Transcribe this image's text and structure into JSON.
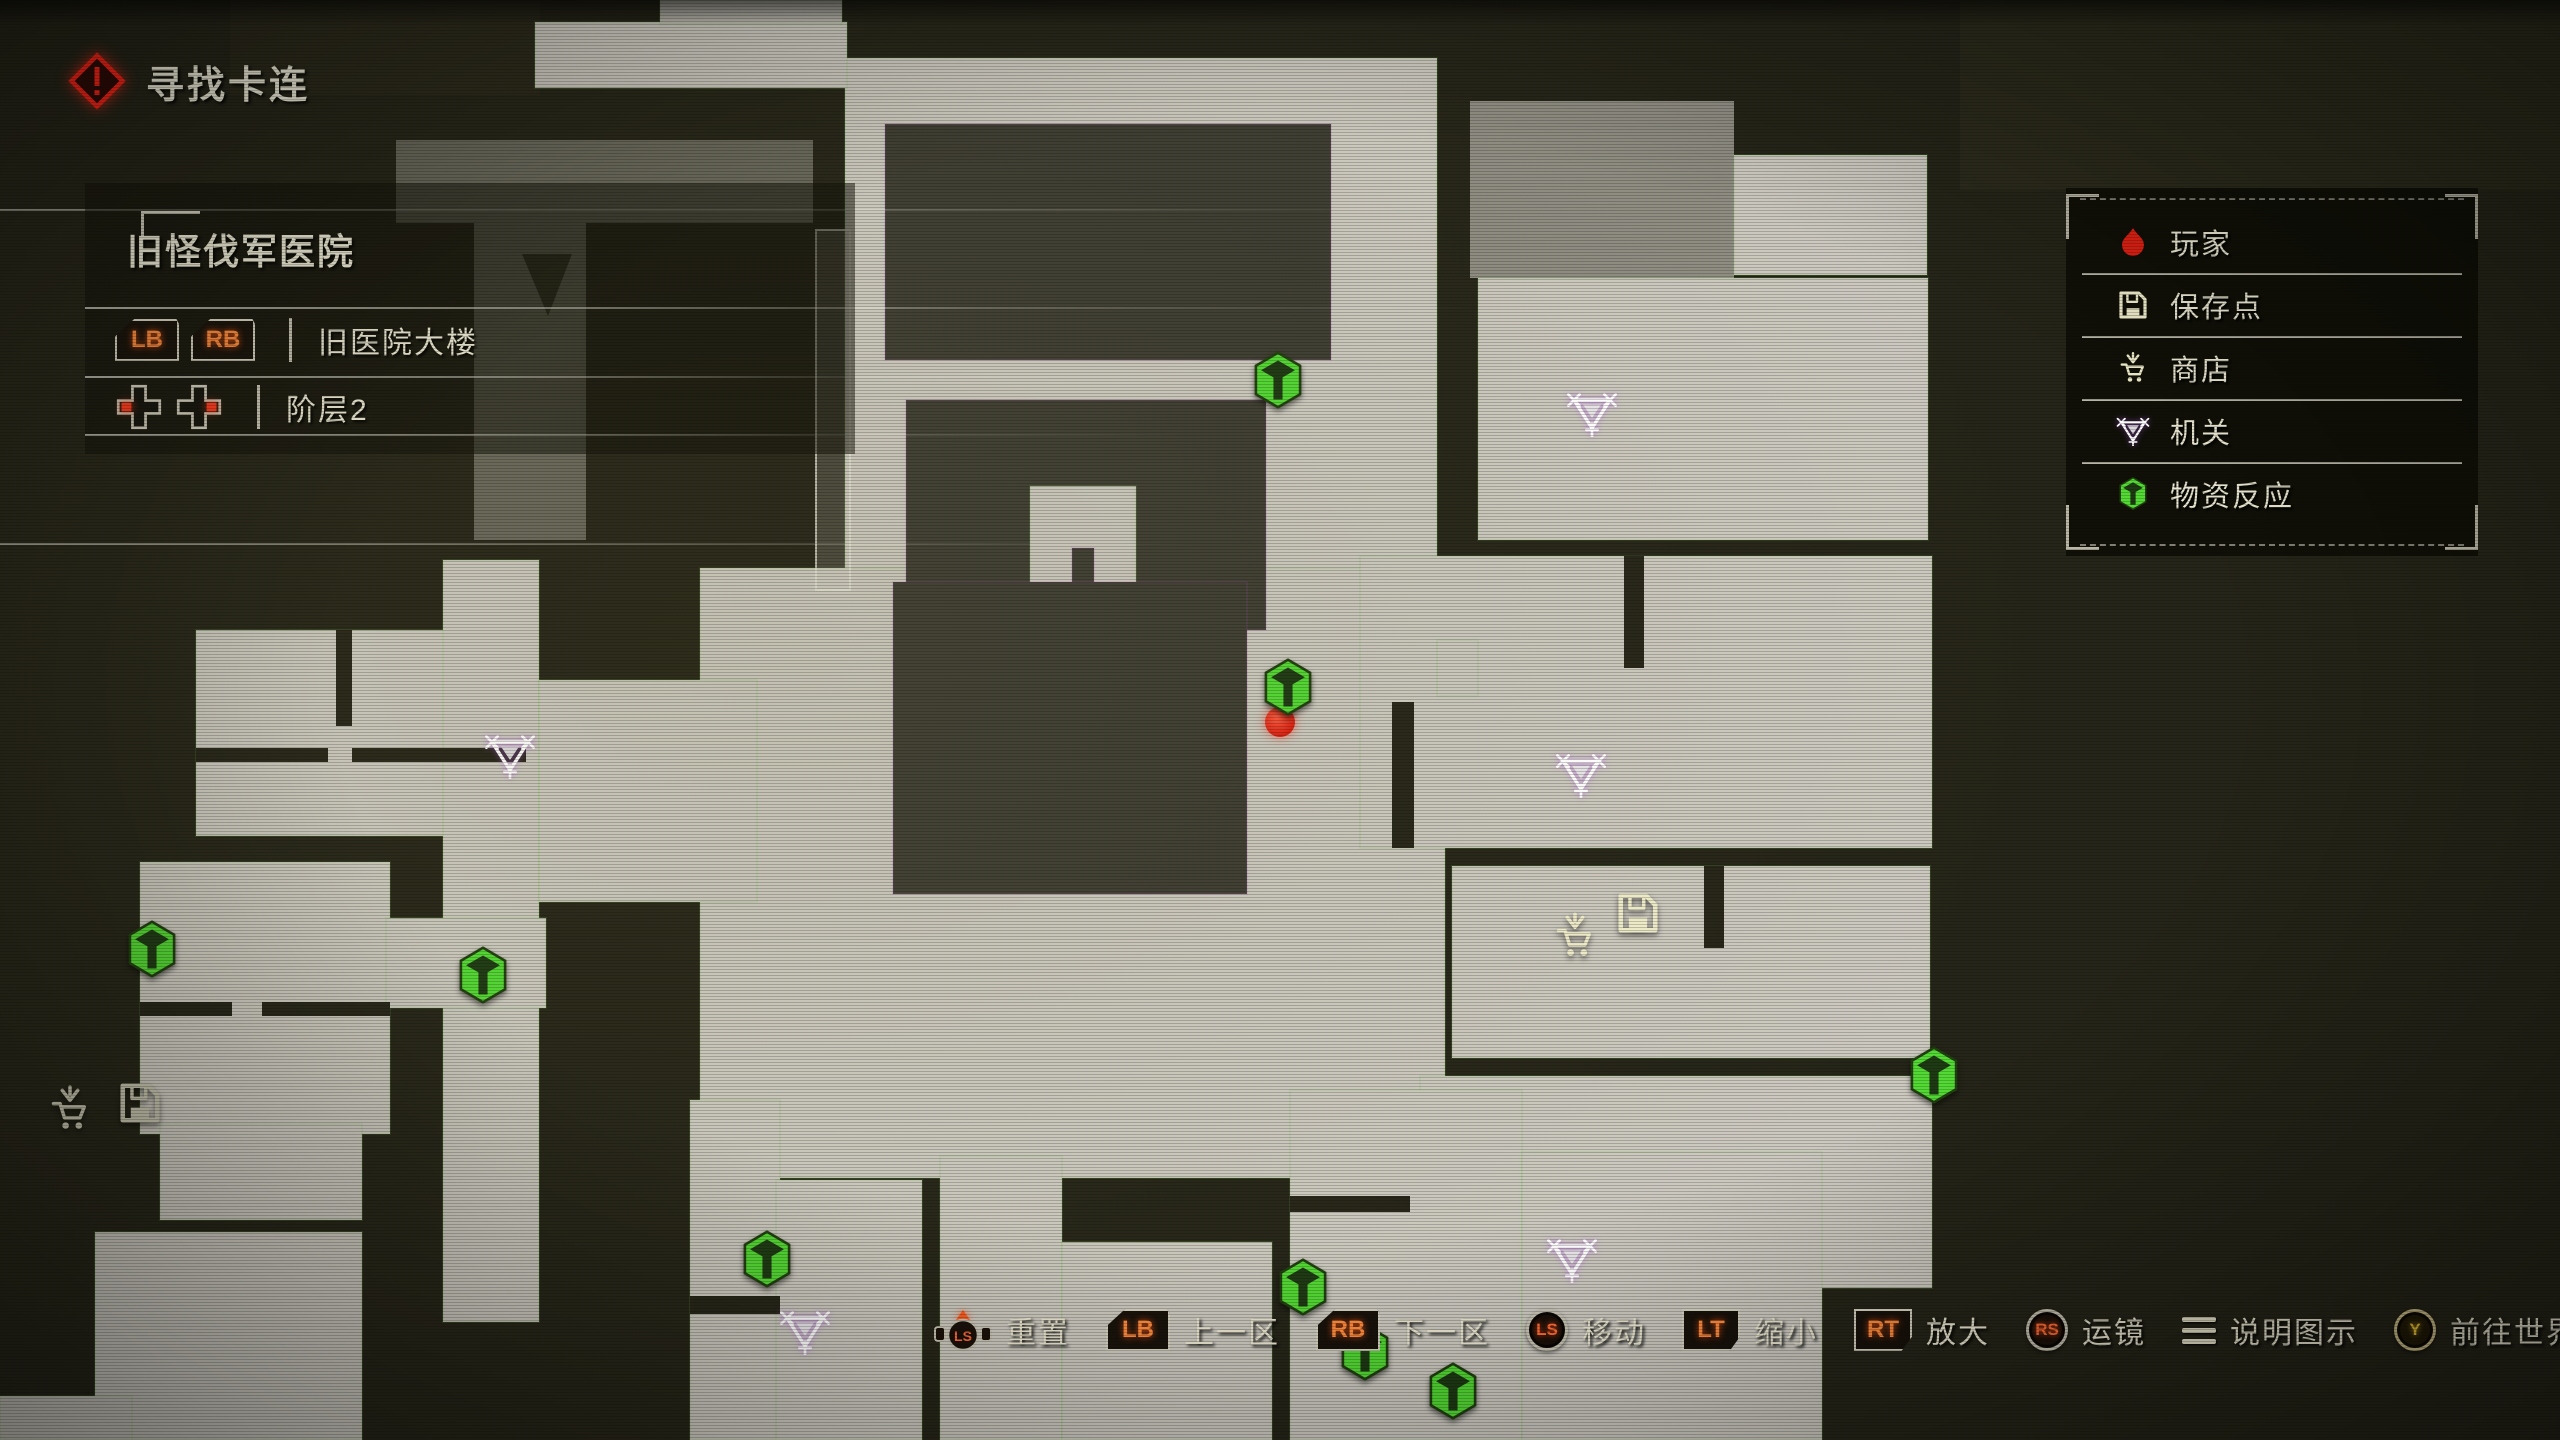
{
  "quest": {
    "icon": "quest-alert-icon",
    "label": "寻找卡连"
  },
  "location_panel": {
    "title": "旧怪伐军医院",
    "area_row": {
      "buttons": [
        "LB",
        "RB"
      ],
      "label": "旧医院大楼"
    },
    "floor_row": {
      "buttons": [
        "dpad-left",
        "dpad-right"
      ],
      "label": "阶层2"
    }
  },
  "legend": {
    "items": [
      {
        "icon": "player-icon",
        "label": "玩家",
        "color": "#ea2519"
      },
      {
        "icon": "save-point-icon",
        "label": "保存点",
        "color": "#eee9c8"
      },
      {
        "icon": "shop-icon",
        "label": "商店",
        "color": "#eee9c8"
      },
      {
        "icon": "mechanism-icon",
        "label": "机关",
        "color": "#ffffff"
      },
      {
        "icon": "supply-reaction-icon",
        "label": "物资反应",
        "color": "#52d933"
      }
    ]
  },
  "controls": [
    {
      "button": "ls-press",
      "label": "重置"
    },
    {
      "button": "lb",
      "label": "上一区"
    },
    {
      "button": "rb",
      "label": "下一区"
    },
    {
      "button": "ls",
      "label": "移动"
    },
    {
      "button": "lt",
      "label": "缩小"
    },
    {
      "button": "rt",
      "label": "放大"
    },
    {
      "button": "rs",
      "label": "运镜"
    },
    {
      "button": "menu",
      "label": "说明图示"
    },
    {
      "button": "y",
      "label": "前往世界地图"
    },
    {
      "button": "b",
      "label": "返回"
    }
  ],
  "map": {
    "location_name": "旧怪伐军医院",
    "markers": [
      {
        "type": "player",
        "x": 1280,
        "y": 722
      },
      {
        "type": "supply",
        "x": 1278,
        "y": 380
      },
      {
        "type": "supply",
        "x": 1288,
        "y": 687
      },
      {
        "type": "supply",
        "x": 152,
        "y": 949
      },
      {
        "type": "supply",
        "x": 483,
        "y": 975
      },
      {
        "type": "supply",
        "x": 1934,
        "y": 1075
      },
      {
        "type": "supply",
        "x": 767,
        "y": 1259
      },
      {
        "type": "supply",
        "x": 1303,
        "y": 1287
      },
      {
        "type": "supply",
        "x": 1365,
        "y": 1352
      },
      {
        "type": "supply",
        "x": 1453,
        "y": 1391
      },
      {
        "type": "mechanism",
        "x": 1592,
        "y": 413
      },
      {
        "type": "mechanism",
        "x": 1581,
        "y": 774
      },
      {
        "type": "mechanism",
        "x": 510,
        "y": 755
      },
      {
        "type": "mechanism",
        "x": 805,
        "y": 1331
      },
      {
        "type": "mechanism",
        "x": 1572,
        "y": 1259
      },
      {
        "type": "shop",
        "x": 1575,
        "y": 935
      },
      {
        "type": "save",
        "x": 1638,
        "y": 913
      },
      {
        "type": "shop",
        "x": 70,
        "y": 1108,
        "dim": true
      },
      {
        "type": "save",
        "x": 140,
        "y": 1103,
        "dim": true
      }
    ]
  },
  "colors": {
    "background": "#262519",
    "room_light": "#ccc9c0",
    "room_dark": "#3e3d33",
    "supply_green": "#52d933",
    "player_red": "#e02013",
    "quest_red": "#ff2418",
    "button_orange": "#ff8a3c",
    "text_cream": "#e8e4cf"
  }
}
